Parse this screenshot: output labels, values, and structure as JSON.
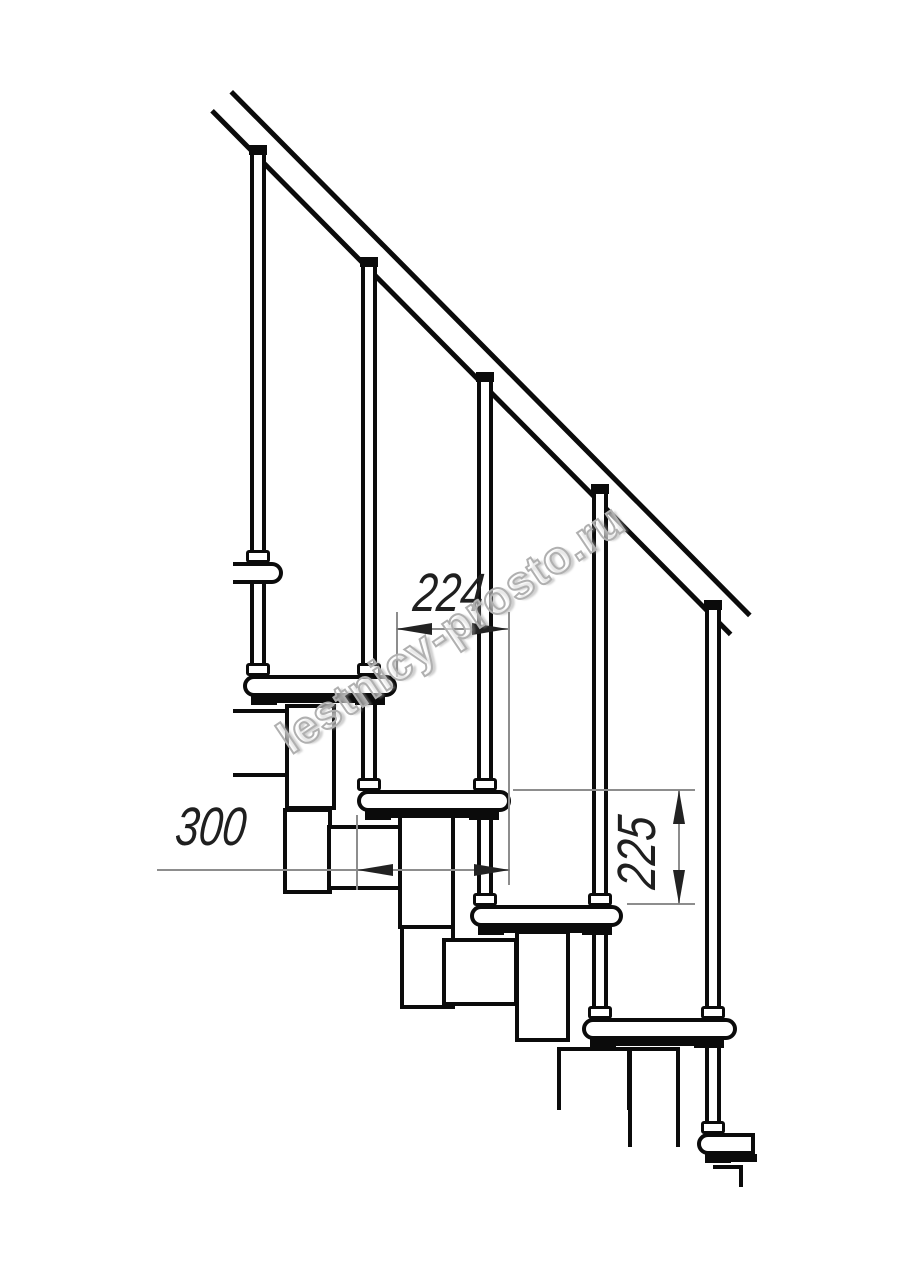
{
  "watermark": {
    "text": "lestnicy-prosto.ru"
  },
  "dimensions": [
    {
      "id": "step-spacing-horizontal",
      "value": "224",
      "orientation": "horizontal"
    },
    {
      "id": "tread-depth",
      "value": "300",
      "orientation": "horizontal"
    },
    {
      "id": "riser-height",
      "value": "225",
      "orientation": "vertical"
    }
  ],
  "colors": {
    "line": "#0b0b0b",
    "dim_line": "#8d8d8d",
    "dim_text": "#1f1f1f",
    "watermark_outline": "#b0b0b0",
    "background": "#ffffff"
  },
  "drawing": {
    "subject": "modular-staircase-side-view"
  }
}
